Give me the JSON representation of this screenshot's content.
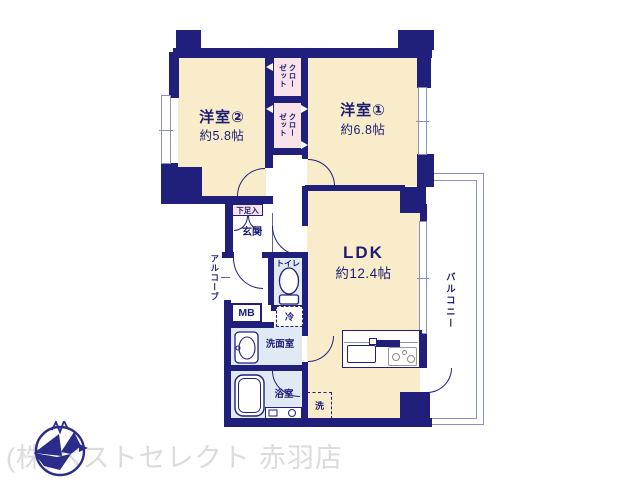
{
  "plan_type": "apartment-floor-plan",
  "rooms": {
    "bedroom2": {
      "name": "洋室②",
      "area": "約5.8帖"
    },
    "bedroom1": {
      "name": "洋室①",
      "area": "約6.8帖"
    },
    "ldk": {
      "name": "LDK",
      "area": "約12.4帖"
    },
    "balcony": {
      "name": "バルコニー"
    },
    "entrance": {
      "name": "玄関"
    },
    "alcove": {
      "name": "アルコーブ"
    },
    "toilet": {
      "name": "トイレ"
    },
    "washroom": {
      "name": "洗面室"
    },
    "bathroom": {
      "name": "浴室"
    }
  },
  "fixtures": {
    "closet_upper": "クローゼット",
    "closet_lower": "クローゼット",
    "shoe_cabinet": "下足入",
    "meter_box": "MB",
    "refrigerator": "冷",
    "washer": "洗",
    "pipe_space": "PS"
  },
  "branding": {
    "store": "(株)ベストセレクト 赤羽店"
  },
  "colors": {
    "wall": "#20207c",
    "room_fill": "#f8ecca",
    "wet_fill": "#dfeaf5",
    "closet_fill": "#f9e2ea",
    "balcony_line": "#8a92c2",
    "watermark": "#dcdcdc"
  }
}
